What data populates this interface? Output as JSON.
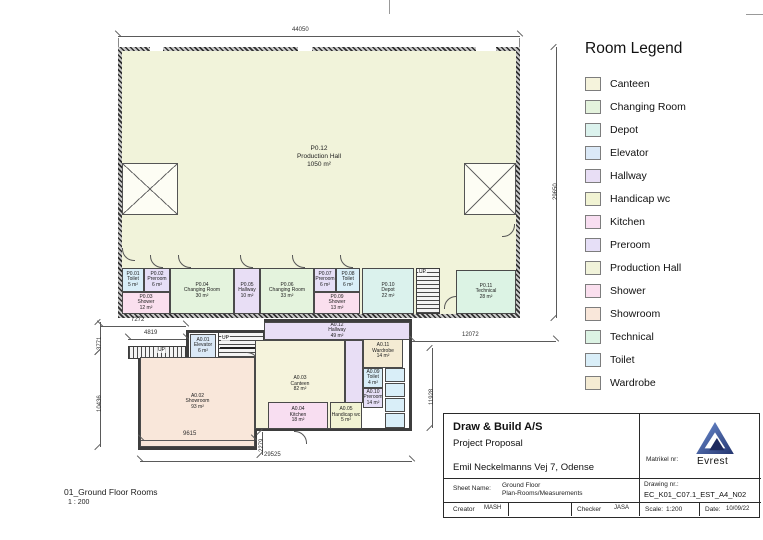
{
  "sheet": {
    "view_title": "01_Ground Floor Rooms",
    "view_scale": "1 : 200",
    "up_label": "UP"
  },
  "legend": {
    "title": "Room Legend",
    "items": [
      {
        "label": "Canteen",
        "color": "#f5f3dc"
      },
      {
        "label": "Changing Room",
        "color": "#e4f3dd"
      },
      {
        "label": "Depot",
        "color": "#dbf2ed"
      },
      {
        "label": "Elevator",
        "color": "#dbe9f7"
      },
      {
        "label": "Hallway",
        "color": "#e8def5"
      },
      {
        "label": "Handicap wc",
        "color": "#f1f3d3"
      },
      {
        "label": "Kitchen",
        "color": "#f8def1"
      },
      {
        "label": "Preroom",
        "color": "#e6dff7"
      },
      {
        "label": "Production Hall",
        "color": "#f1f3da"
      },
      {
        "label": "Shower",
        "color": "#fadfee"
      },
      {
        "label": "Showroom",
        "color": "#f9e7da"
      },
      {
        "label": "Technical",
        "color": "#dcf3e4"
      },
      {
        "label": "Toilet",
        "color": "#d9eef8"
      },
      {
        "label": "Wardrobe",
        "color": "#f4ebd3"
      }
    ]
  },
  "plan": {
    "rooms": [
      {
        "id": "P0.01",
        "name": "Toilet",
        "area": "5 m²",
        "type": "Toilet"
      },
      {
        "id": "P0.02",
        "name": "Preroom",
        "area": "6 m²",
        "type": "Preroom"
      },
      {
        "id": "P0.03",
        "name": "Shower",
        "area": "12 m²",
        "type": "Shower"
      },
      {
        "id": "P0.04",
        "name": "Changing Room",
        "area": "30 m²",
        "type": "Changing Room"
      },
      {
        "id": "P0.05",
        "name": "Hallway",
        "area": "10 m²",
        "type": "Hallway"
      },
      {
        "id": "P0.06",
        "name": "Changing Room",
        "area": "33 m²",
        "type": "Changing Room"
      },
      {
        "id": "P0.07",
        "name": "Preroom",
        "area": "6 m²",
        "type": "Preroom"
      },
      {
        "id": "P0.08",
        "name": "Toilet",
        "area": "6 m²",
        "type": "Toilet"
      },
      {
        "id": "P0.09",
        "name": "Shower",
        "area": "13 m²",
        "type": "Shower"
      },
      {
        "id": "P0.10",
        "name": "Depot",
        "area": "22 m²",
        "type": "Depot"
      },
      {
        "id": "P0.11",
        "name": "Technical",
        "area": "28 m²",
        "type": "Technical"
      },
      {
        "id": "P0.12",
        "name": "Production Hall",
        "area": "1050 m²",
        "type": "Production Hall"
      },
      {
        "id": "A0.01",
        "name": "Elevator",
        "area": "6 m²",
        "type": "Elevator"
      },
      {
        "id": "A0.02",
        "name": "Showroom",
        "area": "93 m²",
        "type": "Showroom"
      },
      {
        "id": "A0.03",
        "name": "Canteen",
        "area": "82 m²",
        "type": "Canteen"
      },
      {
        "id": "A0.04",
        "name": "Kitchen",
        "area": "18 m²",
        "type": "Kitchen"
      },
      {
        "id": "A0.05",
        "name": "Handicap wc",
        "area": "5 m²",
        "type": "Handicap wc"
      },
      {
        "id": "A0.09",
        "name": "Toilet",
        "area": "4 m²",
        "type": "Toilet"
      },
      {
        "id": "A0.10",
        "name": "Preroom",
        "area": "14 m²",
        "type": "Preroom"
      },
      {
        "id": "A0.11",
        "name": "Wardrobe",
        "area": "14 m²",
        "type": "Wardrobe"
      },
      {
        "id": "A0.12",
        "name": "Hallway",
        "area": "49 m²",
        "type": "Hallway"
      }
    ]
  },
  "dimensions": {
    "hall_width": "44050",
    "hall_height": "29650",
    "mid_right": "12072",
    "annex_right": "11928",
    "upper_left_a": "7272",
    "upper_left_b": "4819",
    "left_small": "3771",
    "left_large": "10436",
    "showroom_width": "9615",
    "offset_small": "2279",
    "annex_width": "29525"
  },
  "title_block": {
    "company": "Draw & Build A/S",
    "proposal": "Project Proposal",
    "address": "Emil Neckelmanns Vej 7, Odense",
    "matrikel_label": "Matrikel nr:",
    "logo_text": "Evrest",
    "sheet_name_label": "Sheet Name:",
    "sheet_name_line1": "Ground Floor",
    "sheet_name_line2": "Plan-Rooms/Measurements",
    "drawing_nr_label": "Drawing nr.:",
    "drawing_nr_value": "EC_K01_C07.1_EST_A4_N02",
    "creator_label": "Creator",
    "creator_value": "MASH",
    "checker_label": "Checker",
    "checker_value": "JASA",
    "scale_label": "Scale:",
    "scale_value": "1:200",
    "date_label": "Date:",
    "date_value": "10/09/22"
  }
}
